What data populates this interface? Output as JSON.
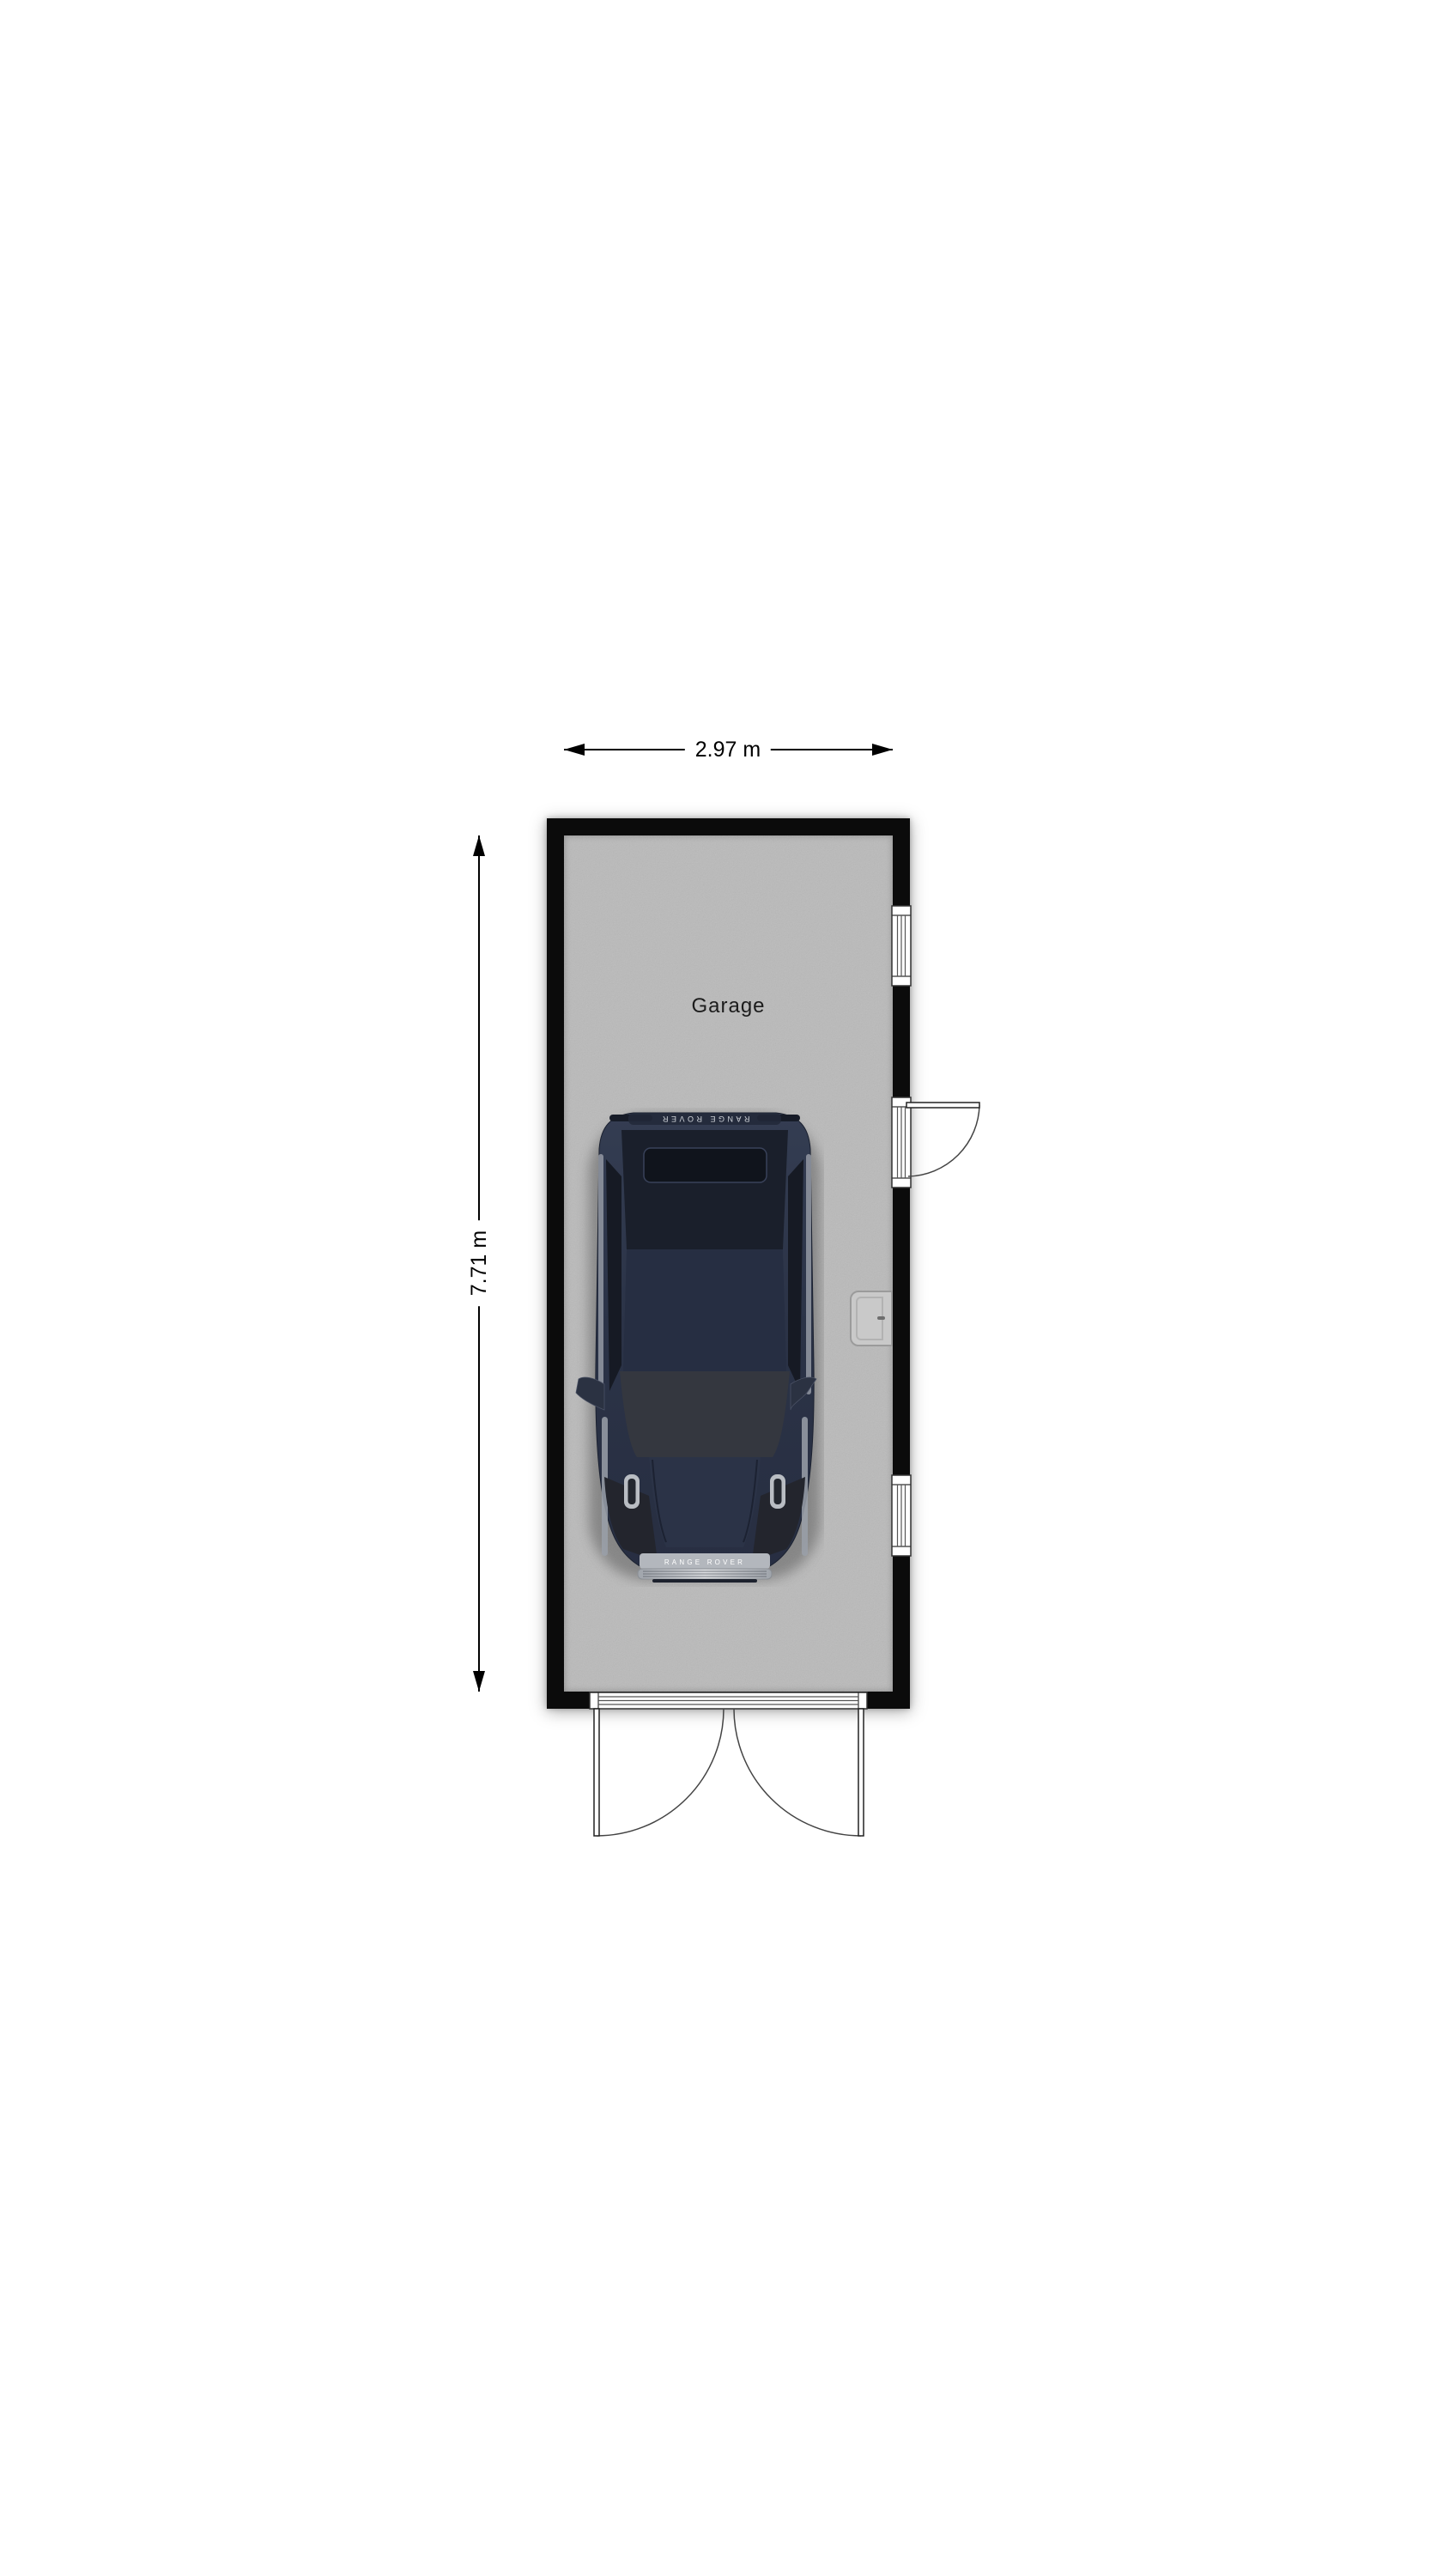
{
  "floorplan": {
    "room": {
      "label": "Garage"
    },
    "dimensions": {
      "width": "2.97 m",
      "height": "7.71 m"
    },
    "car": {
      "badge_front": "RANGE ROVER",
      "badge_rear": "RANGE ROVER"
    },
    "colors": {
      "wall": "#0b0b0b",
      "floor": "#bababa",
      "background": "#ffffff",
      "car_body": "#2b3347",
      "car_glass": "#1a1f2b",
      "car_windshield": "#34373f",
      "dimension_text": "#000000"
    }
  }
}
